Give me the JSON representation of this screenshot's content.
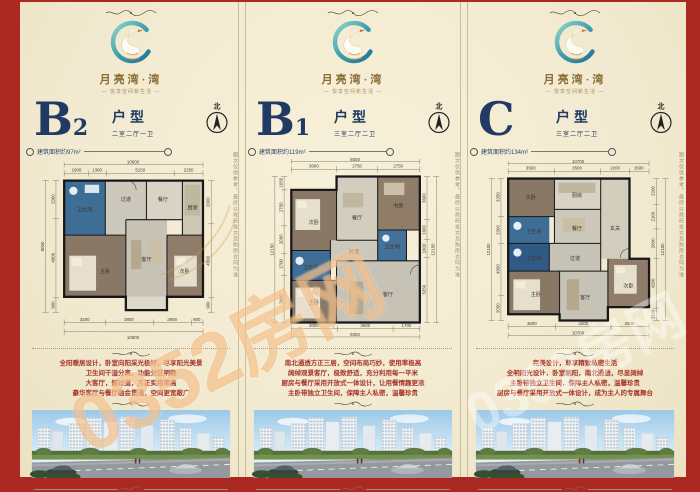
{
  "page": {
    "watermark_main": "0352房网",
    "watermark_secondary": "0352房网",
    "side_note": "图文仅供参考，最终以政府批文及购房合同为准"
  },
  "brand": {
    "name": "月亮湾·湾",
    "tagline": "— 悦享空间新生活 —",
    "north_label": "北"
  },
  "panels": [
    {
      "letter": "B",
      "sub": "2",
      "type_label": "户型",
      "layout_label": "二室二厅一卫",
      "area_label": "建筑面积约97m²",
      "desc1": "全阳暖居设计，卧室向阳采光极好，尽享阳光美景",
      "desc2": "卫生间干湿分离，功能分区明确",
      "desc3": "大客厅，短过道，方正实用率高",
      "desc4": "豪华客厅与餐厅融会贯通，空间更宽敞广",
      "plan": {
        "rooms": {
          "bath": "卫生间",
          "hall": "过道",
          "dining": "餐厅",
          "kitchen": "厨房",
          "living": "客厅",
          "master": "主卧",
          "second": "次卧"
        },
        "dims_top": [
          "1900",
          "1300",
          "5150",
          "2250"
        ],
        "top_total": "10600",
        "dims_bottom": [
          "3200",
          "3800",
          "2900",
          "900"
        ],
        "bottom_total": "10800",
        "dims_left": [
          "2300",
          "4800",
          "900"
        ],
        "left_total": "8000",
        "dims_right": [
          "2600",
          "4500",
          "900"
        ]
      }
    },
    {
      "letter": "B",
      "sub": "1",
      "type_label": "户型",
      "layout_label": "三室二厅二卫",
      "area_label": "建筑面积约119m²",
      "desc1": "南北通透方正三居，空间布局巧妙，使用率极高",
      "desc2": "阔绰观景客厅，极致舒适，充分利用每一平米",
      "desc3": "厨房与餐厅采用开放式一体设计，让用餐情趣更浓",
      "desc4": "主卧带独立卫生间，保障主人私密，温馨珍贵",
      "plan": {
        "rooms": {
          "second": "次卧",
          "study": "书房",
          "dining": "餐厅",
          "bath1": "卫生间",
          "bath2": "卫生间",
          "master": "主卧",
          "living": "客厅",
          "hall": "过道"
        },
        "dims_top": [
          "3000",
          "2750",
          "2750"
        ],
        "top_total": "8500",
        "dims_bottom": [
          "3000",
          "3600",
          "1700"
        ],
        "bottom_total": "8300",
        "dims_left": [
          "1050",
          "2750",
          "2090",
          "1700",
          "3600"
        ],
        "left_total": "12150",
        "dims_right": [
          "3600",
          "1600",
          "1600",
          "5350"
        ],
        "right_total": "12150"
      }
    },
    {
      "letter": "C",
      "sub": "",
      "type_label": "户型",
      "layout_label": "三室二厅二卫",
      "area_label": "建筑面积约134m²",
      "desc1": "完美设计，尊享精致私密生活",
      "desc2": "全明阳光设计，卧室朝阳，南北通透，尽显阔绰",
      "desc3": "主卧带独立卫生间，保障主人私密，温馨珍贵",
      "desc4": "厨房与餐厅采用开放式一体设计，成为主人的专属舞台",
      "plan": {
        "rooms": {
          "second": "次卧",
          "kitchen": "厨房",
          "dining": "餐厅",
          "foyer": "玄关",
          "bath1": "卫生间",
          "bath2": "卫生间",
          "hall": "过道",
          "master": "主卧",
          "living": "客厅",
          "second2": "次卧"
        },
        "dims_top": [
          "3500",
          "3500",
          "2200",
          "1500"
        ],
        "top_total": "10700",
        "dims_bottom": [
          "3600",
          "4200",
          "2900"
        ],
        "bottom_total": "10700",
        "dims_left": [
          "3250",
          "2300",
          "4500",
          "2050"
        ],
        "left_total": "12100",
        "dims_right": [
          "2200",
          "2100",
          "2600",
          "4200",
          "1100"
        ],
        "right_total": "12100"
      }
    }
  ]
}
